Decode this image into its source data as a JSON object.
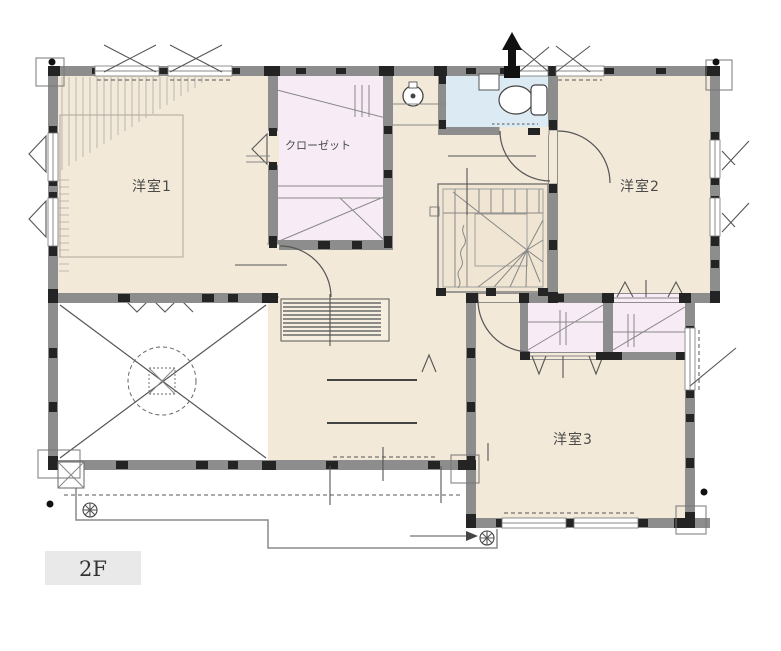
{
  "floor_plan": {
    "floor_label": "2F",
    "rooms": {
      "room1": {
        "label": "洋室1"
      },
      "room2": {
        "label": "洋室2"
      },
      "room3": {
        "label": "洋室3"
      },
      "closet": {
        "label": "クローゼット"
      }
    },
    "colors": {
      "room_fill": "#f2e9d8",
      "closet_fill": "#f7ecf6",
      "toilet_fill": "#dcebf3",
      "stairs_fill": "#efe5d2",
      "counter_fill": "#f6efe0",
      "wall": "#8d8d8d",
      "joint": "#242424",
      "line": "#555555",
      "floor_tag_bg": "#e9e9e9"
    },
    "icons": {
      "toilet": "toilet-fixture-icon",
      "fan": "exhaust-fan-icon",
      "vent": "vent-stack-arrow-icon",
      "drain": "balcony-drain-icon"
    }
  }
}
